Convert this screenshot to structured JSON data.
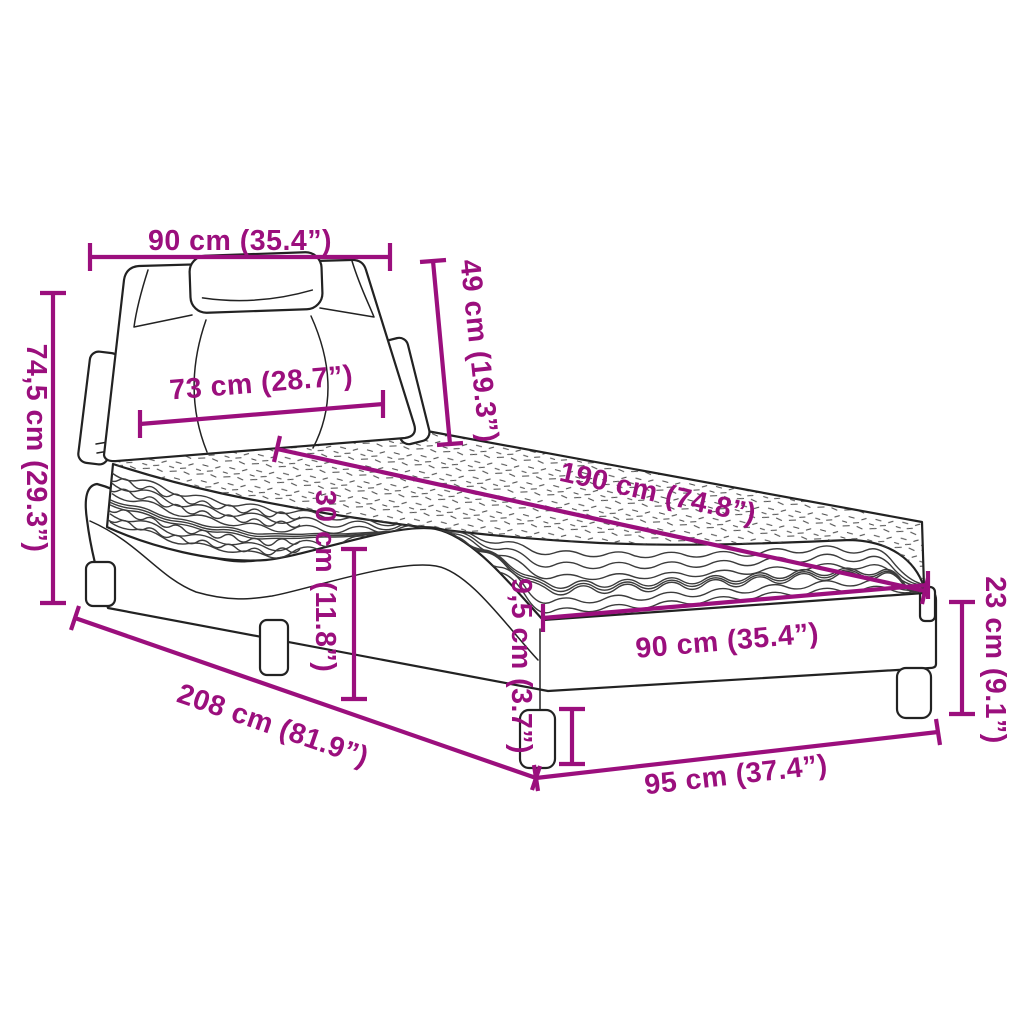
{
  "meta": {
    "title": "Bed with mattress — dimension diagram",
    "style": "technical line drawing with dimension callouts"
  },
  "colors": {
    "accent": "#9B0F7D",
    "ink": "#222222",
    "background": "#ffffff"
  },
  "dimensions": {
    "headboard_width": "90 cm (35.4”)",
    "headboard_height": "49 cm (19.3”)",
    "overall_height": "74,5 cm (29.3”)",
    "headboard_inner_width": "73 cm (28.7”)",
    "mattress_length": "190 cm (74.8”)",
    "platform_height": "30 cm (11.8”)",
    "leg_height": "9,5 cm (3.7”)",
    "mattress_width": "90 cm (35.4”)",
    "frame_end_height": "23 cm (9.1”)",
    "overall_length": "208 cm (81.9”)",
    "frame_width": "95 cm (37.4”)"
  }
}
